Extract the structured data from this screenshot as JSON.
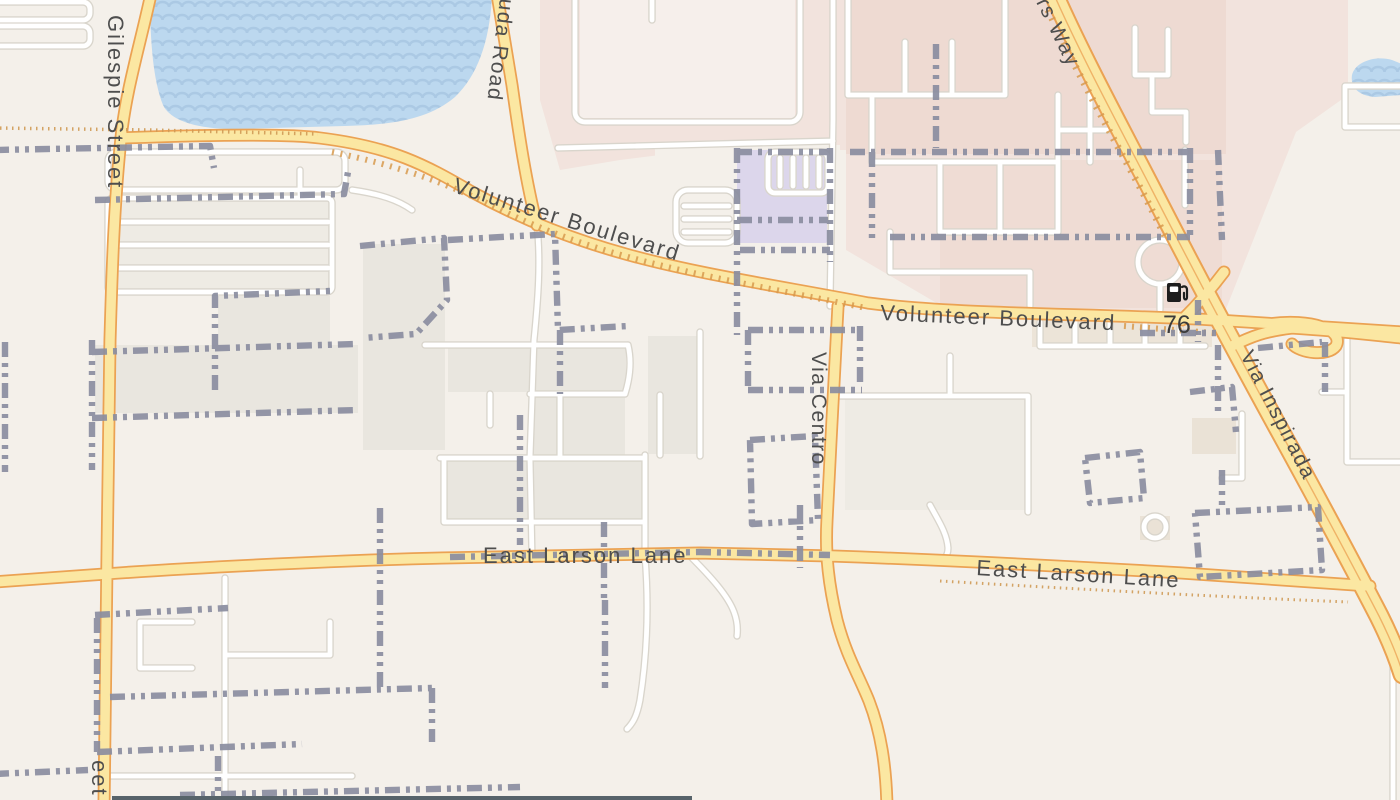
{
  "map": {
    "type": "street-map-tile",
    "labels": [
      {
        "name": "gilespie-street",
        "text": "Gilespie Street"
      },
      {
        "name": "gilespie-street-partial",
        "text": "eet"
      },
      {
        "name": "bermuda-road-partial",
        "text": "uda Road"
      },
      {
        "name": "way-road-partial",
        "text": "rs Way"
      },
      {
        "name": "volunteer-boulevard-northwest",
        "text": "Volunteer Boulevard"
      },
      {
        "name": "volunteer-boulevard-east",
        "text": "Volunteer Boulevard"
      },
      {
        "name": "via-centro",
        "text": "Via Centro"
      },
      {
        "name": "via-inspirada",
        "text": "Via Inspirada"
      },
      {
        "name": "east-larson-lane-west",
        "text": "East Larson Lane"
      },
      {
        "name": "east-larson-lane-east",
        "text": "East Larson Lane"
      }
    ],
    "pois": [
      {
        "name": "gas-station",
        "label": "76",
        "icon": "fuel-pump-icon"
      }
    ],
    "colors": {
      "land": "#f4f0ea",
      "water": "#bcd8ef",
      "water_wave": "#abc9e4",
      "commercial_pink": "#f2e3dd",
      "commercial_pink_dark": "#eedad2",
      "civic_purple": "#dcd6eb",
      "block_gray": "#e9e6df",
      "road_yellow": "#fbe7a2",
      "road_yellow_casing": "#eba253",
      "road_white": "#ffffff",
      "road_white_casing": "#d9d5cc",
      "boundary_dash": "#8a8d9f",
      "label_text": "#4e4e4e"
    },
    "features": {
      "lake": "top-left with wave pattern",
      "pond": "right edge small water body",
      "boundary_style": "gray dash-dot lines"
    }
  }
}
